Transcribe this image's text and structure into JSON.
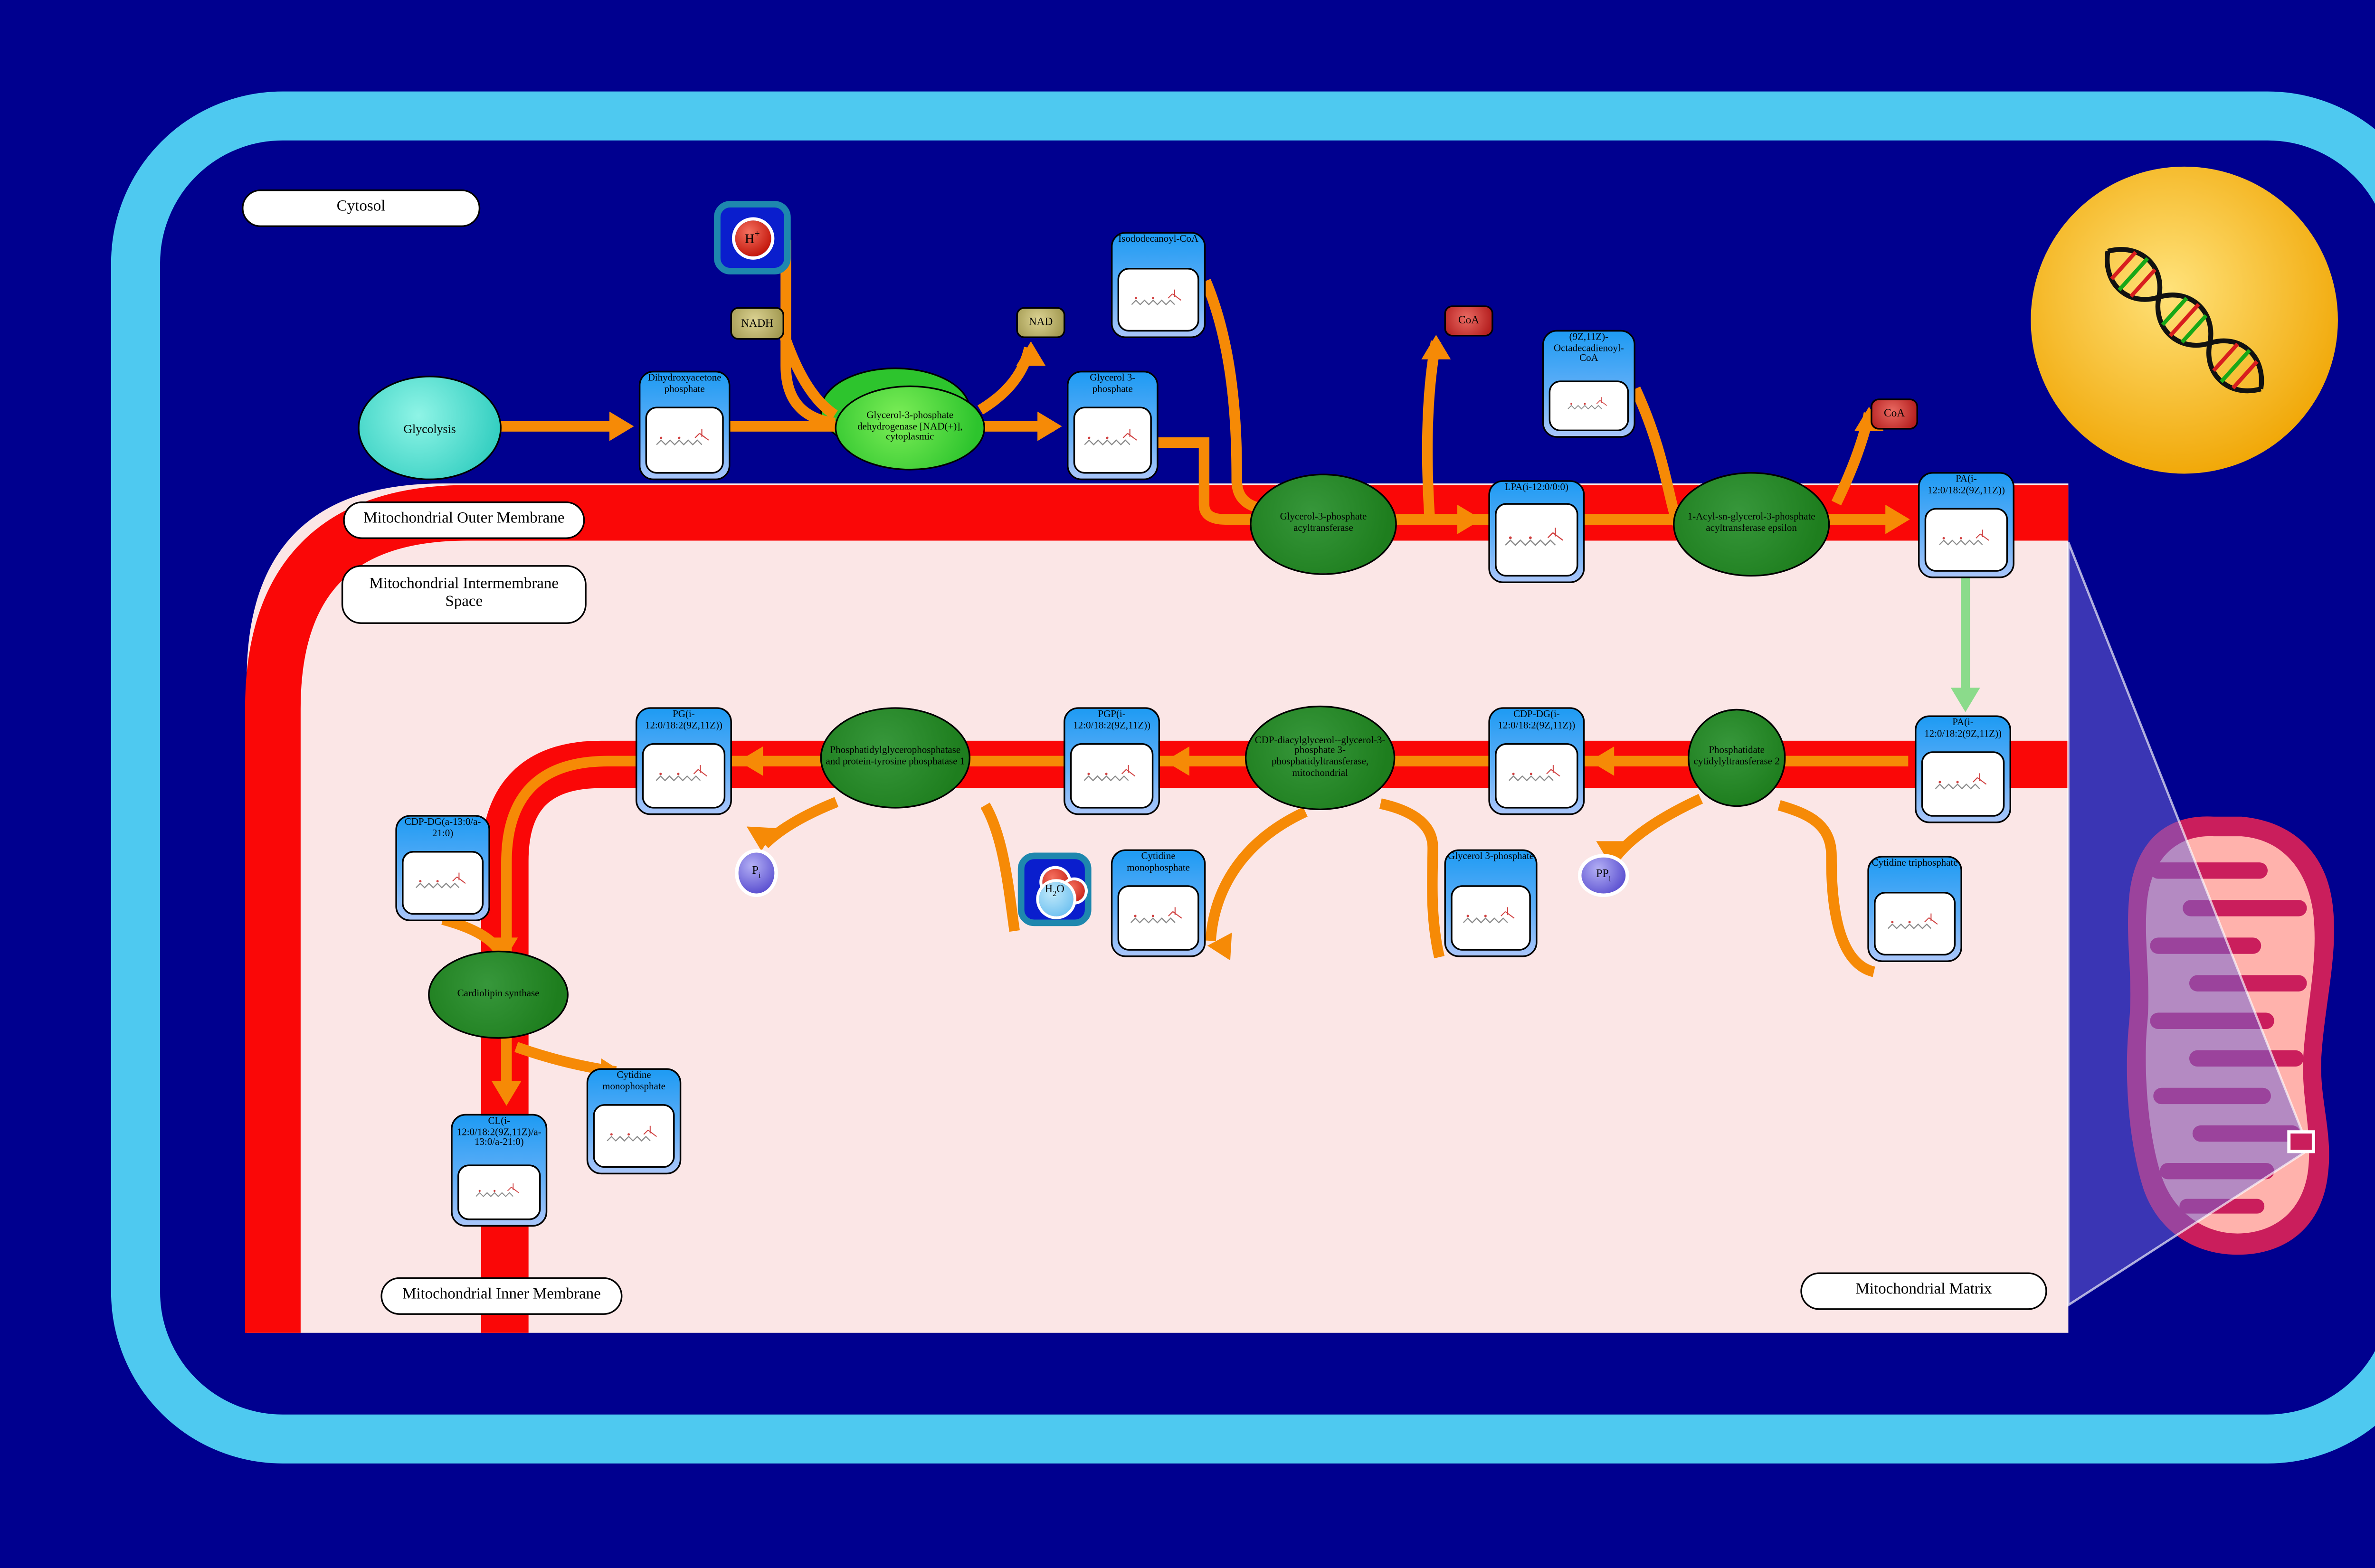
{
  "diagram": {
    "compartments": {
      "cytosol": "Cytosol",
      "outer_membrane": "Mitochondrial Outer Membrane",
      "intermembrane_space": "Mitochondrial Intermembrane Space",
      "inner_membrane": "Mitochondrial Inner Membrane",
      "matrix": "Mitochondrial Matrix"
    },
    "process": {
      "glycolysis": "Glycolysis"
    },
    "enzymes": {
      "gpd1": "Glycerol-3-phosphate dehydrogenase [NAD(+)], cytoplasmic",
      "gpat": "Glycerol-3-phosphate acyltransferase",
      "agpat_epsilon": "1-Acyl-sn-glycerol-3-phosphate acyltransferase epsilon",
      "ptpmt1": "Phosphatidylglycerophosphatase and protein-tyrosine phosphatase 1",
      "pgs1": "CDP-diacylglycerol--glycerol-3-phosphate 3-phosphatidyltransferase, mitochondrial",
      "cds2": "Phosphatidate cytidylyltransferase 2",
      "crls": "Cardiolipin synthase"
    },
    "metabolites": {
      "dhap": "Dihydroxyacetone phosphate",
      "g3p_cytosol": "Glycerol 3-phosphate",
      "isododecanoyl_coa": "Isododecanoyl-CoA",
      "octadecadienoyl_coa": "(9Z,11Z)-Octadecadienoyl-CoA",
      "lpa": "LPA(i-12:0/0:0)",
      "pa_outer": "PA(i-12:0/18:2(9Z,11Z))",
      "pa_inner": "PA(i-12:0/18:2(9Z,11Z))",
      "cdp_dg": "CDP-DG(i-12:0/18:2(9Z,11Z))",
      "pgp": "PGP(i-12:0/18:2(9Z,11Z))",
      "pg": "PG(i-12:0/18:2(9Z,11Z))",
      "cdp_dg_a": "CDP-DG(a-13:0/a-21:0)",
      "cl": "CL(i-12:0/18:2(9Z,11Z)/a-13:0/a-21:0)",
      "cmp_matrix": "Cytidine monophosphate",
      "cmp_inner": "Cytidine monophosphate",
      "g3p_matrix": "Glycerol 3-phosphate",
      "ctp": "Cytidine triphosphate"
    },
    "cofactors": {
      "nadh": "NADH",
      "nad": "NAD",
      "coa_upper": "CoA",
      "coa_right": "CoA",
      "h_plus_base": "H",
      "h_plus_sup": "+",
      "pi_base": "P",
      "pi_sub": "i",
      "ppi_base": "PP",
      "ppi_sub": "i",
      "h2o_h": "H",
      "h2o_2": "2",
      "h2o_o": "O"
    },
    "colors": {
      "background": "#00008F",
      "cell_border": "#4EC9F0",
      "membrane_red": "#FA0707",
      "matrix_pink": "#FBE6E6",
      "arrow_orange": "#F68A06",
      "transport_green": "#8BDB8B",
      "node_blue": "#1E9BF3",
      "enzyme_green_bright": "#2DC42D",
      "enzyme_green_dark": "#1E7E1E",
      "nucleus_gold": "#F5B80C",
      "mitochondrion_crimson": "#CA1E5C"
    }
  }
}
